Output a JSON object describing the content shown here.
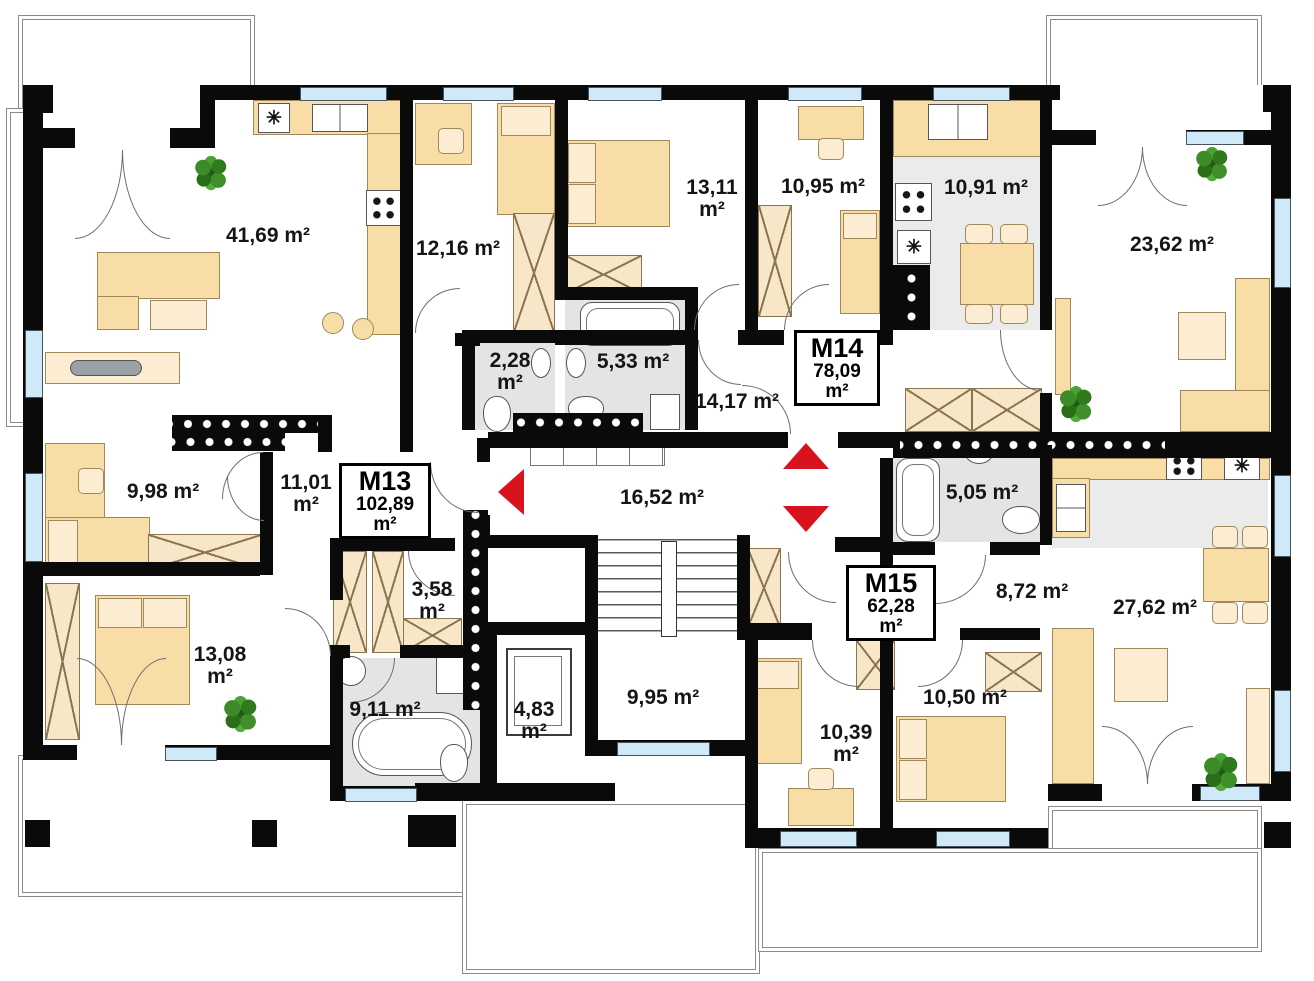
{
  "apartments": {
    "m13": {
      "code": "M13",
      "area": "102,89 m²"
    },
    "m14": {
      "code": "M14",
      "area": "78,09 m²"
    },
    "m15": {
      "code": "M15",
      "area": "62,28 m²"
    }
  },
  "rooms": {
    "living_m13": {
      "label": "41,69 m²"
    },
    "bedroom_1216": {
      "label": "12,16 m²"
    },
    "bedroom_1311": {
      "line1": "13,11",
      "line2": "m²"
    },
    "bedroom_1095": {
      "label": "10,95 m²"
    },
    "kitchen_1091": {
      "label": "10,91 m²"
    },
    "living_2362": {
      "label": "23,62 m²"
    },
    "wc_228": {
      "line1": "2,28",
      "line2": "m²"
    },
    "bath_533": {
      "label": "5,33 m²"
    },
    "hall_1417": {
      "label": "14,17 m²"
    },
    "room_998": {
      "label": "9,98 m²"
    },
    "hall_1101": {
      "line1": "11,01",
      "line2": "m²"
    },
    "corridor_1652": {
      "label": "16,52 m²"
    },
    "closet_358": {
      "line1": "3,58",
      "line2": "m²"
    },
    "bedroom_1308": {
      "line1": "13,08",
      "line2": "m²"
    },
    "bath_911": {
      "label": "9,11 m²"
    },
    "elevator_483": {
      "line1": "4,83",
      "line2": "m²"
    },
    "stairs_995": {
      "label": "9,95 m²"
    },
    "bath_505": {
      "label": "5,05 m²"
    },
    "hall_872": {
      "label": "8,72 m²"
    },
    "living_2762": {
      "label": "27,62 m²"
    },
    "bedroom_1039": {
      "line1": "10,39",
      "line2": "m²"
    },
    "bedroom_1050": {
      "label": "10,50 m²"
    }
  },
  "icons": {
    "snowflake": "✳"
  },
  "colors": {
    "wall": "#0a0a0a",
    "bath_floor": "#e3e4e4",
    "furniture": "#f8dda6",
    "window": "#cfe9f8",
    "arrow_red": "#d8131f",
    "plant_green": "#3c8a28"
  }
}
